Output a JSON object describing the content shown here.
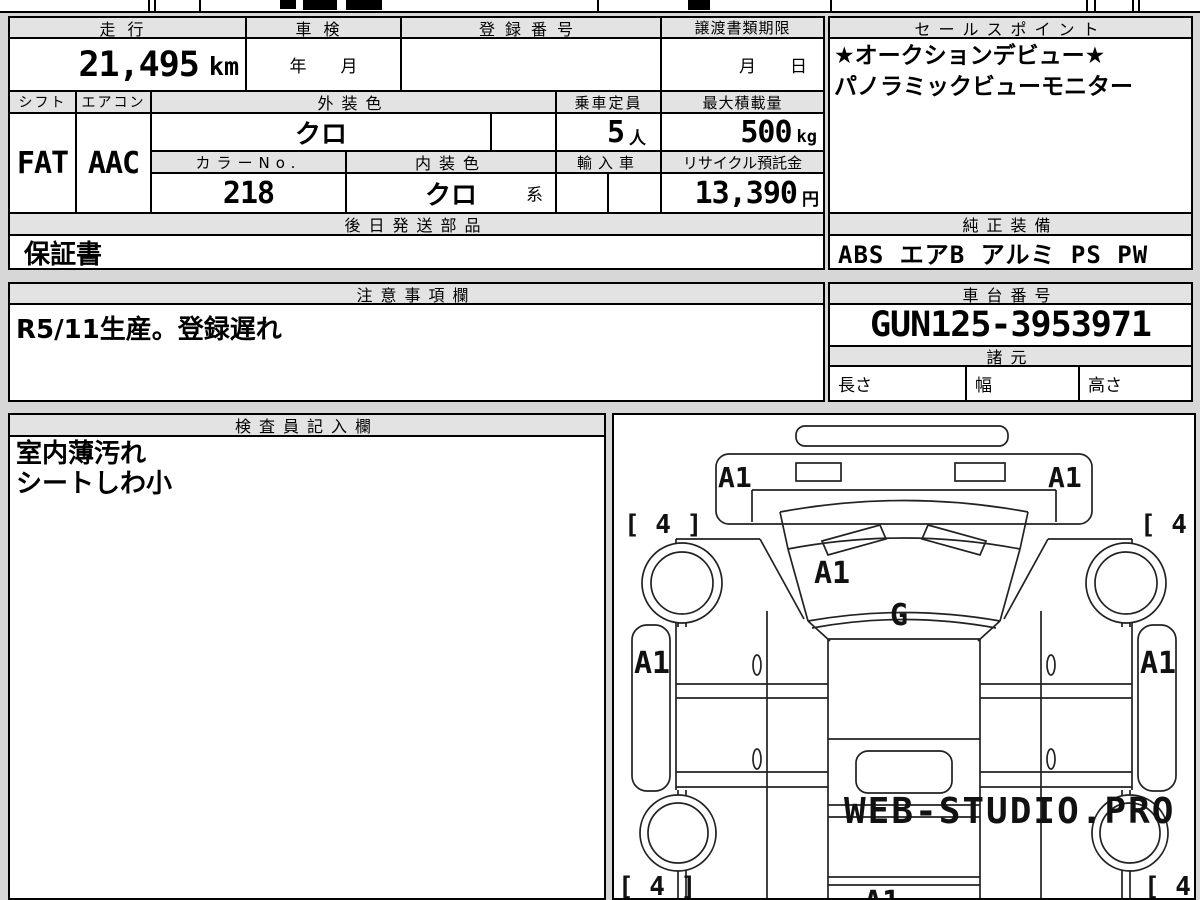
{
  "sheet": {
    "row1": {
      "mileage_header": "走行",
      "mileage_value": "21,495",
      "mileage_unit": "km",
      "shaken_header": "車検",
      "shaken_value": "年　　月",
      "registration_header": "登録番号",
      "registration_value": "",
      "transfer_header": "譲渡書類期限",
      "transfer_value": "月　　日"
    },
    "row2": {
      "shift_header": "シフト",
      "shift_value": "FAT",
      "aircon_header": "エアコン",
      "aircon_value": "AAC",
      "exterior_header": "外装色",
      "exterior_value": "クロ",
      "capacity_header": "乗車定員",
      "capacity_value": "5",
      "capacity_unit": "人",
      "load_header": "最大積載量",
      "load_value": "500",
      "load_unit": "kg"
    },
    "row3": {
      "colorno_header": "カラーNo.",
      "colorno_value": "218",
      "interior_header": "内装色",
      "interior_value": "クロ",
      "interior_suffix": "系",
      "import_header": "輸入車",
      "recycle_header": "リサイクル預託金",
      "recycle_value": "13,390",
      "recycle_unit": "円"
    },
    "later_parts": {
      "header": "後日発送部品",
      "value": "保証書"
    },
    "sales_point": {
      "header": "セールスポイント",
      "line1": "★オークションデビュー★",
      "line2": "パノラミックビューモニター"
    },
    "equipment": {
      "header": "純正装備",
      "value": "ABS エアB アルミ PS PW"
    },
    "notes": {
      "header": "注意事項欄",
      "value": "R5/11生産。登録遅れ"
    },
    "chassis": {
      "header": "車台番号",
      "value": "GUN125-3953971"
    },
    "specs": {
      "header": "諸元",
      "length": "長さ",
      "width": "幅",
      "height": "高さ"
    },
    "inspector": {
      "header": "検査員記入欄",
      "line1": "室内薄汚れ",
      "line2": "シートしわ小"
    }
  },
  "diagram": {
    "bumper_left": "A1",
    "bumper_right": "A1",
    "hood": "A1",
    "glass": "G",
    "door_left": "A1",
    "door_right": "A1",
    "rear": "A1",
    "tire_front_left": "[ 4 ]",
    "tire_front_right": "[ 4 ]",
    "tire_rear_left": "[ 4 ]",
    "tire_rear_right": "[ 4 ]",
    "watermark": "WEB-STUDIO.PRO"
  }
}
